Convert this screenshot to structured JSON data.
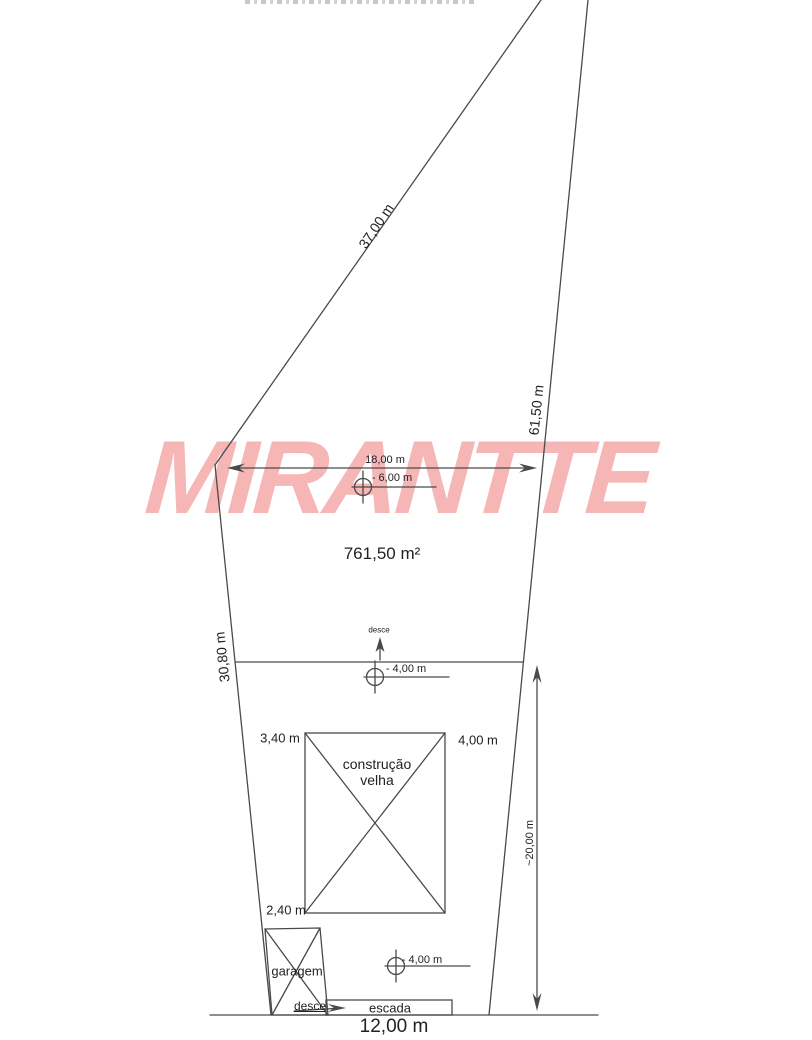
{
  "watermark": {
    "text": "MIRANTTE",
    "color": "#f6b6b6"
  },
  "colors": {
    "watermark_pink": "#f6b6b6",
    "line": "#4a4a4a",
    "text": "#222222"
  },
  "labels": {
    "dim_37": "37,00 m",
    "dim_61_50": "61,50 m",
    "dim_30_80": "30,80 m",
    "dim_18": "18,00 m",
    "level_minus6": "- 6,00 m",
    "area": "761,50 m²",
    "desce_upper": "desce",
    "level_minus4_upper": "- 4,00 m",
    "dim_3_40": "3,40 m",
    "dim_4_00": "4,00 m",
    "construcao_line1": "construção",
    "construcao_line2": "velha",
    "dim_20": "~20,00 m",
    "dim_2_40": "2,40 m",
    "garagem": "garagem",
    "level_minus4_lower": "- 4,00 m",
    "desce_lower": "desce",
    "escada": "escada",
    "dim_12": "12,00 m"
  }
}
